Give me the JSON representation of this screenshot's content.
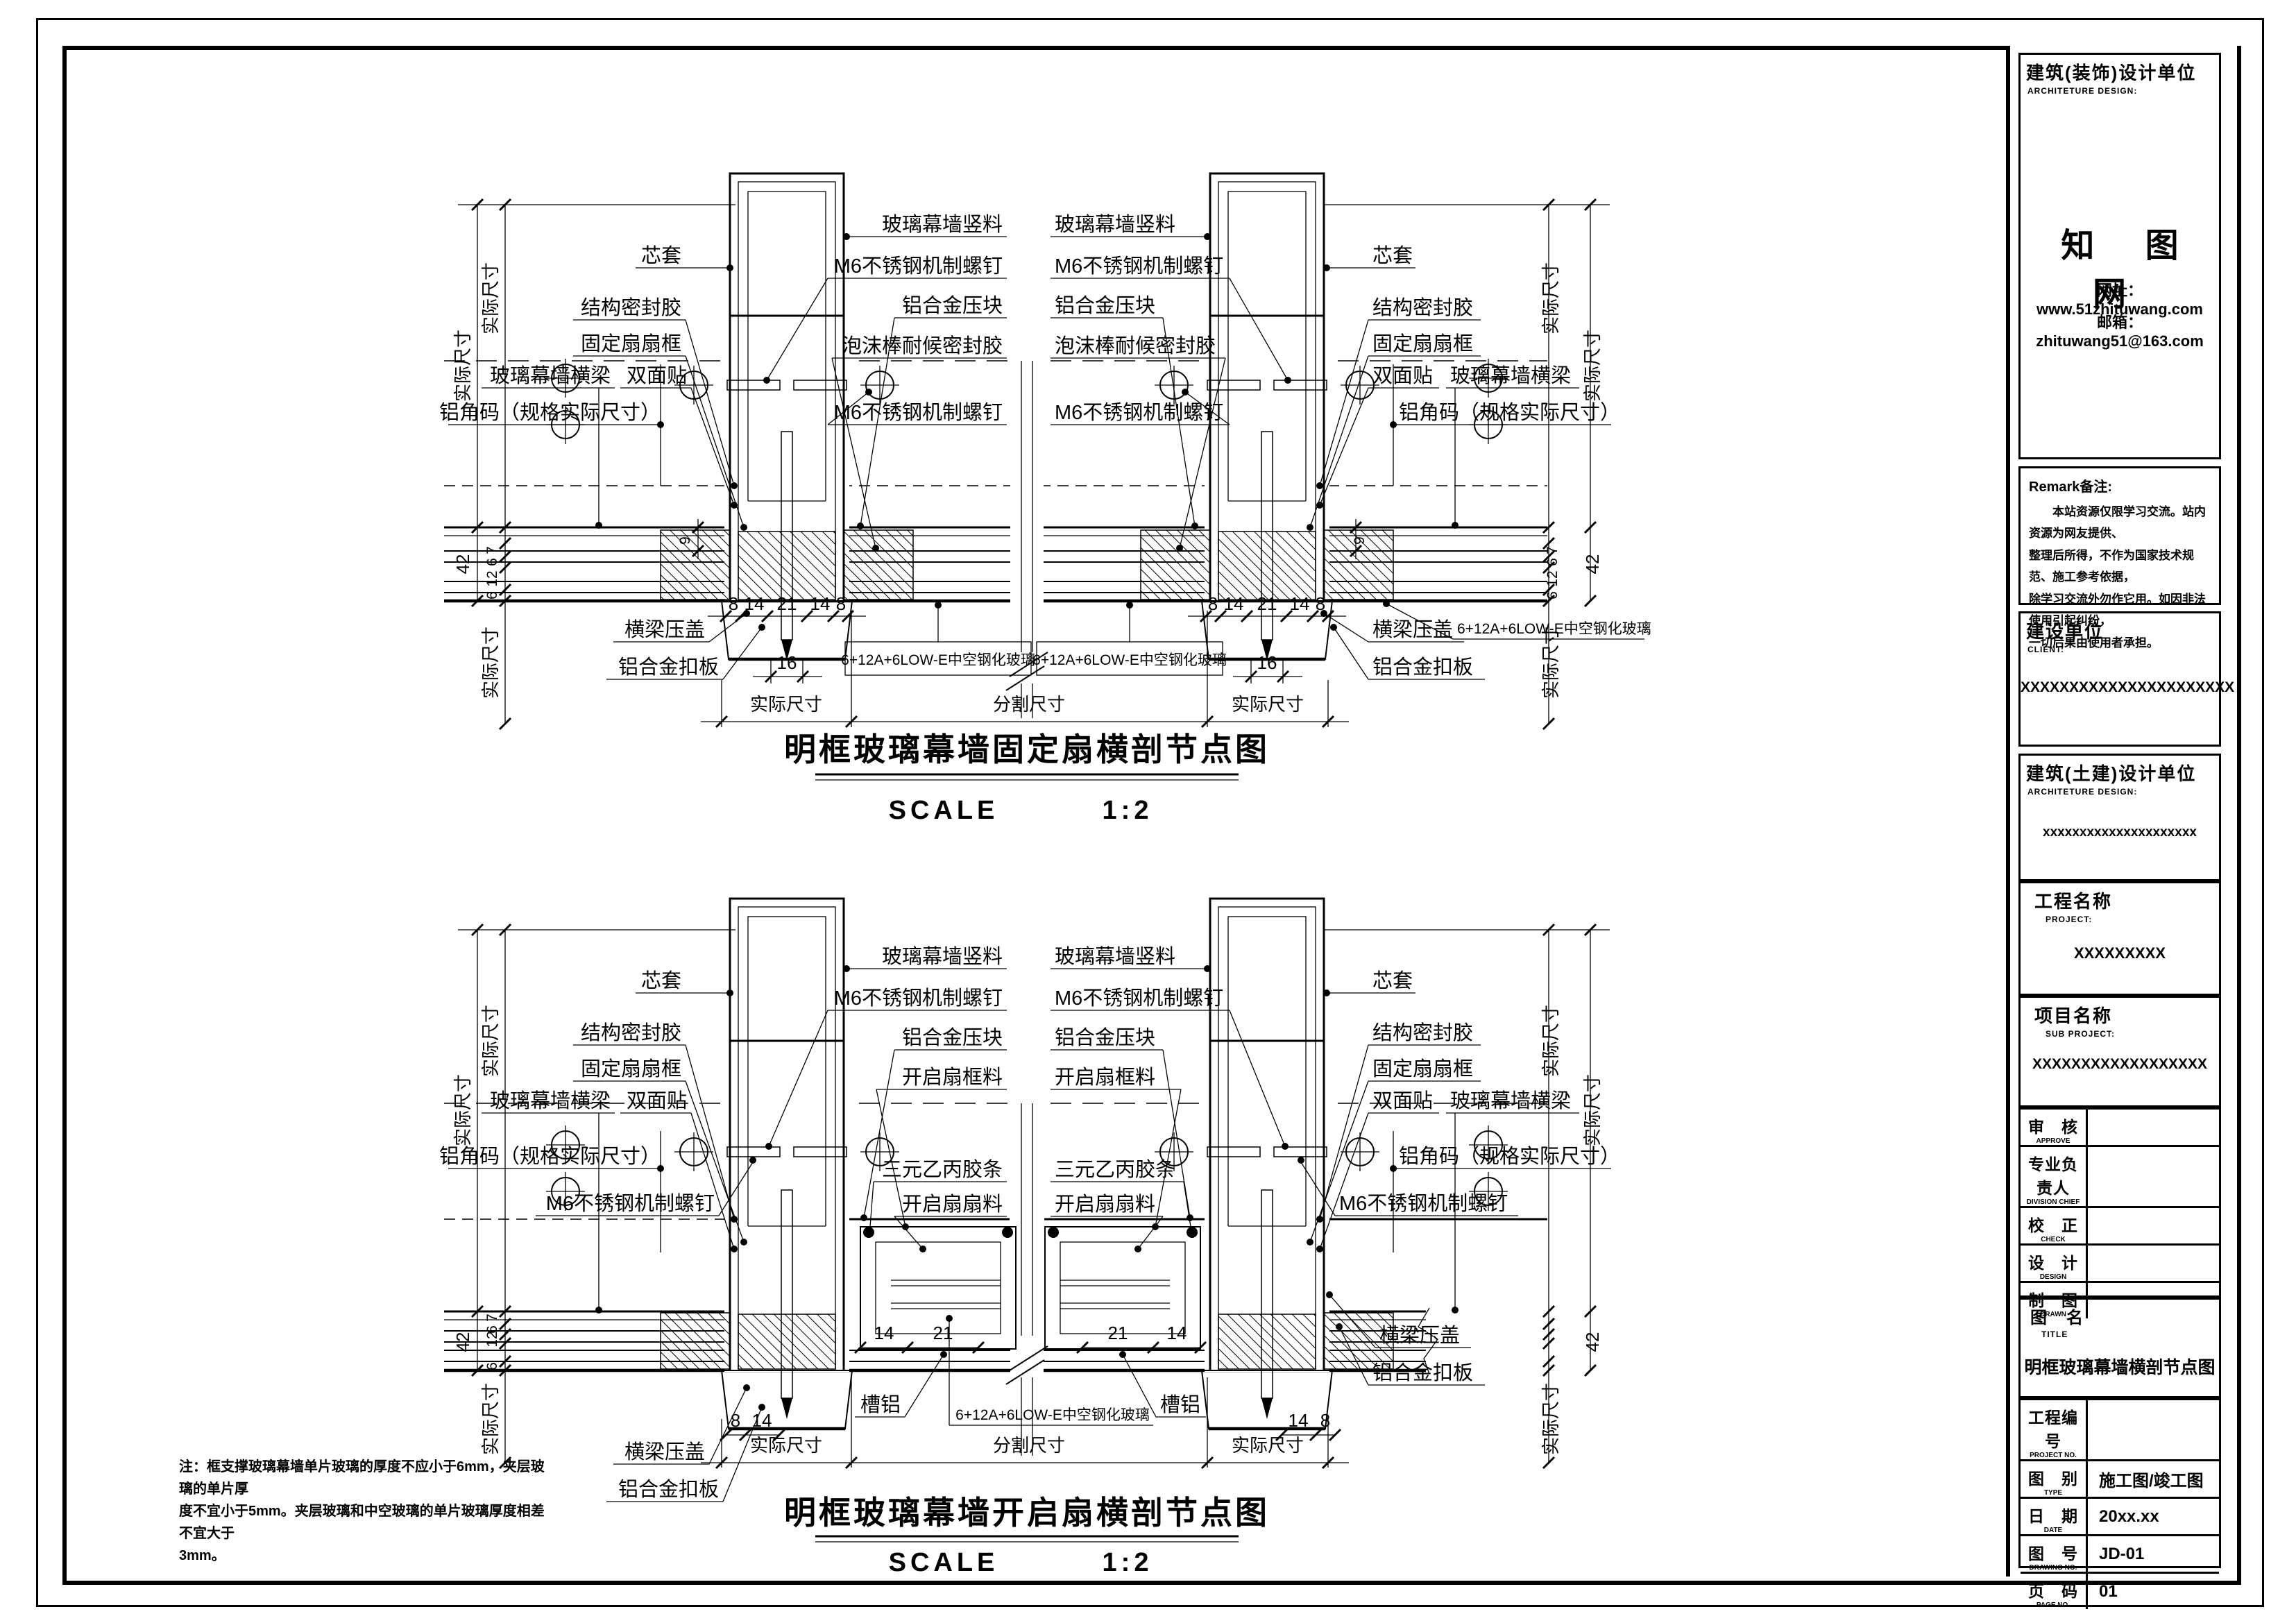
{
  "titles": {
    "drawing1": "明框玻璃幕墙固定扇横剖节点图",
    "drawing2": "明框玻璃幕墙开启扇横剖节点图",
    "scale_label": "SCALE",
    "scale_value": "1:2"
  },
  "labels": {
    "xintao": "芯套",
    "jiegou_mifengjiao": "结构密封胶",
    "gudingshan_shankuang": "固定扇扇框",
    "boli_hengliang": "玻璃幕墙横梁",
    "shuangmiantie": "双面贴",
    "boli_shuliao": "玻璃幕墙竖料",
    "m6_luoding": "M6不锈钢机制螺钉",
    "lvhejin_yakuai": "铝合金压块",
    "paomobang": "泡沫棒耐候密封胶",
    "lvjiaoma": "铝角码（规格实际尺寸）",
    "hengliang_yagai": "横梁压盖",
    "lvhejin_kouban": "铝合金扣板",
    "glass_spec": "6+12A+6LOW-E中空钢化玻璃",
    "kaiqishan_kuangliao": "开启扇框料",
    "sanyuan_jiaotiao": "三元乙丙胶条",
    "kaiqishan_shanliao": "开启扇扇料",
    "caolv": "槽铝",
    "shiji_chicun": "实际尺寸",
    "fenge_chicun": "分割尺寸"
  },
  "dims": {
    "n8": "8",
    "n14": "14",
    "n21": "21",
    "n16": "16",
    "n42": "42",
    "n7": "7",
    "n6": "6",
    "n12": "12",
    "n9": "9"
  },
  "note": [
    "注：框支撑玻璃幕墙单片玻璃的厚度不应小于6mm，夹层玻璃的单片厚",
    "度不宜小于5mm。夹层玻璃和中空玻璃的单片玻璃厚度相差不宜大于",
    "3mm。"
  ],
  "title_block": {
    "deco_design": {
      "cn": "建筑(装饰)设计单位",
      "en": "ARCHITETURE DESIGN:"
    },
    "logo": "知 图 网",
    "website_label": "网址：",
    "website": "www.51zhituwang.com",
    "email_label": "邮箱：",
    "email": "zhituwang51@163.com",
    "remark_title": "Remark备注:",
    "remark_lines": [
      "本站资源仅限学习交流。站内资源为网友提供、",
      "整理后所得，不作为国家技术规范、施工参考依据，",
      "除学习交流外勿作它用。如因非法使用引起纠纷，",
      "一切后果由使用者承担。"
    ],
    "client": {
      "cn": "建设单位",
      "en": "CLIENT:",
      "value": "XXXXXXXXXXXXXXXXXXXXXX"
    },
    "civil_design": {
      "cn": "建筑(土建)设计单位",
      "en": "ARCHITETURE DESIGN:",
      "value": "xxxxxxxxxxxxxxxxxxxxx"
    },
    "project": {
      "cn": "工程名称",
      "en": "PROJECT:",
      "value": "XXXXXXXXX"
    },
    "sub_project": {
      "cn": "项目名称",
      "en": "SUB PROJECT:",
      "value": "XXXXXXXXXXXXXXXXXX"
    },
    "rows": [
      {
        "cn": "审　核",
        "en": "APPROVE",
        "value": ""
      },
      {
        "cn": "专业负责人",
        "en": "DIVISION CHIEF",
        "value": ""
      },
      {
        "cn": "校　正",
        "en": "CHECK",
        "value": ""
      },
      {
        "cn": "设　计",
        "en": "DESIGN",
        "value": ""
      },
      {
        "cn": "制　图",
        "en": "DRAWN",
        "value": ""
      }
    ],
    "drawing_title": {
      "cn": "图　名",
      "en": "TITLE",
      "value": "明框玻璃幕墙横剖节点图"
    },
    "meta_rows": [
      {
        "cn": "工程编号",
        "en": "PROJECT NO.",
        "value": ""
      },
      {
        "cn": "图　别",
        "en": "TYPE",
        "value": "施工图/竣工图"
      },
      {
        "cn": "日　期",
        "en": "DATE",
        "value": "20xx.xx"
      },
      {
        "cn": "图　号",
        "en": "DRAWING NO.",
        "value": "JD-01"
      },
      {
        "cn": "页　码",
        "en": "PAGE NO.",
        "value": "01"
      }
    ]
  }
}
